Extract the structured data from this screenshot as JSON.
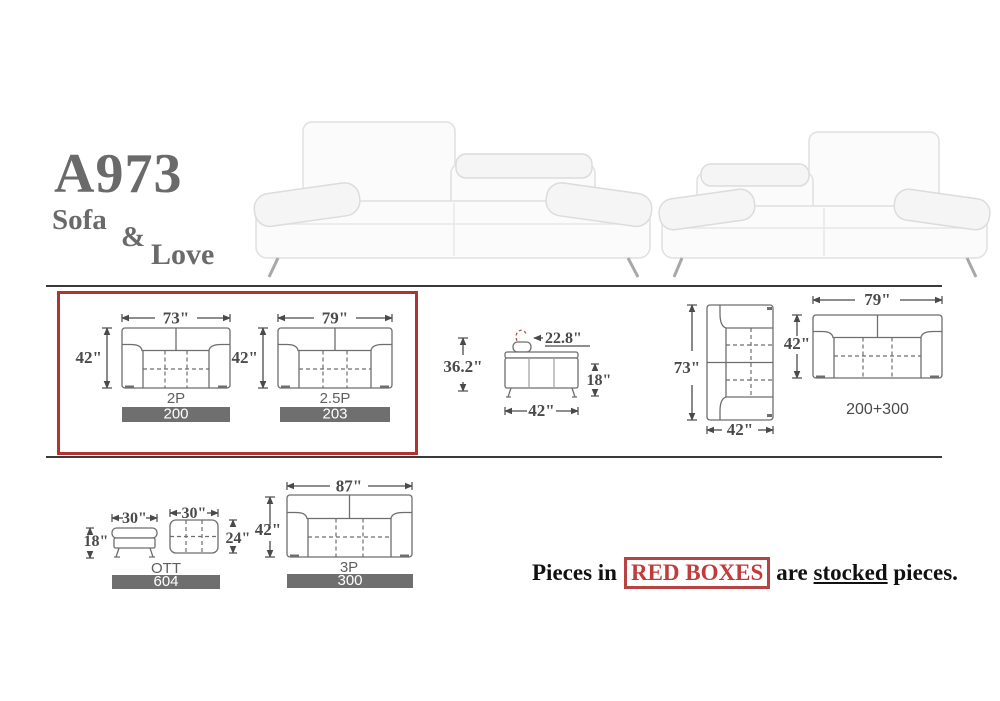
{
  "header": {
    "model": "A973",
    "type_line1": "Sofa",
    "ampersand": "&",
    "type_line2": "Love"
  },
  "footer": {
    "prefix": "Pieces in",
    "highlight": "RED BOXES",
    "middle": "are",
    "underlined": "stocked",
    "suffix": "pieces."
  },
  "diagrams": {
    "sofa_2p": {
      "width": "73\"",
      "depth": "42\"",
      "label": "2P",
      "code": "200"
    },
    "sofa_25p": {
      "width": "79\"",
      "depth": "42\"",
      "label": "2.5P",
      "code": "203"
    },
    "side_view": {
      "total_height": "36.2\"",
      "back_depth": "22.8\"",
      "seat_height": "18\"",
      "depth": "42\""
    },
    "loveseat_top": {
      "length": "73\"",
      "depth": "42\""
    },
    "combo_top": {
      "width": "79\"",
      "depth": "42\"",
      "code": "200+300"
    },
    "ottoman": {
      "front_width": "30\"",
      "height": "18\"",
      "top_width": "30\"",
      "top_depth": "24\"",
      "label": "OTT",
      "code": "604"
    },
    "sofa_3p": {
      "width": "87\"",
      "depth": "42\"",
      "label": "3P",
      "code": "300"
    }
  },
  "colors": {
    "accent_red": "#b23131",
    "highlight_red": "#c23b3b",
    "bar_gray": "#6f6f6f",
    "diagram_line_gray": "#6e6e6e",
    "dimension_text_gray": "#4a4a4a",
    "title_gray": "#6a6a6a",
    "rule_dark": "#3a3a3a"
  }
}
